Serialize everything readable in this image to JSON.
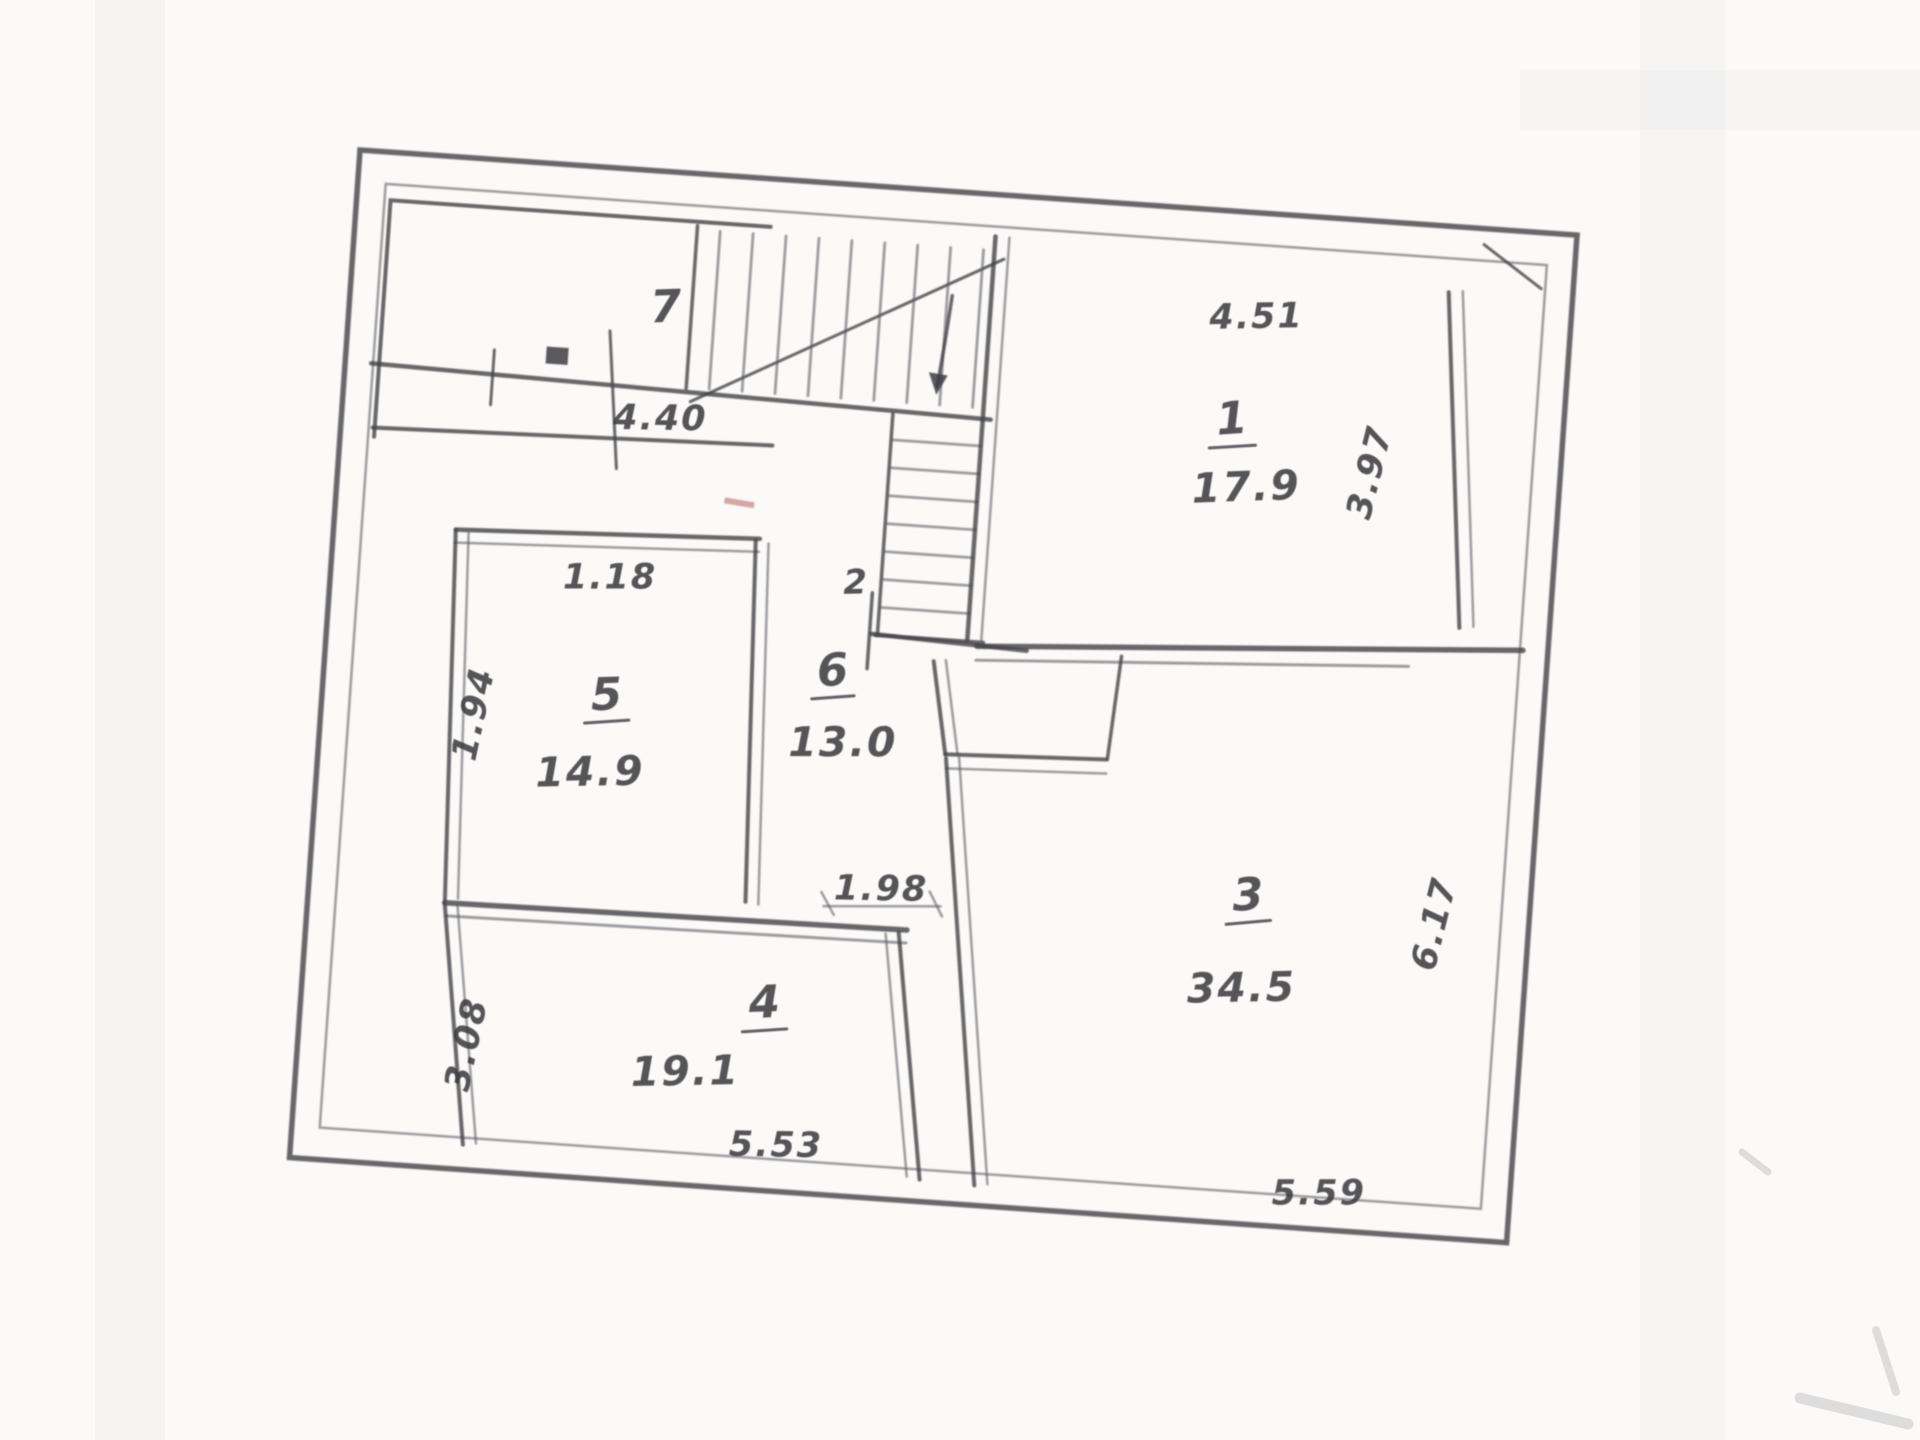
{
  "plan": {
    "room_numbers": {
      "r1": "1",
      "r2": "2",
      "r3": "3",
      "r4": "4",
      "r5": "5",
      "r6": "6",
      "r7": "7"
    },
    "areas": {
      "r1": "17.9",
      "r3": "34.5",
      "r4": "19.1",
      "r5": "14.9",
      "r6": "13.0"
    },
    "dims": {
      "top_left": "4.40",
      "room1_top": "4.51",
      "room1_side": "3.97",
      "room5_top": "1.18",
      "room5_side": "1.94",
      "hall": "1.98",
      "room4_side": "3.08",
      "room4_bottom": "5.53",
      "room3_side": "6.17",
      "room3_bottom": "5.59"
    },
    "palette": {
      "ink": "#45454b",
      "paper": "#fbfaf8",
      "accent_red": "#b2534f"
    }
  }
}
